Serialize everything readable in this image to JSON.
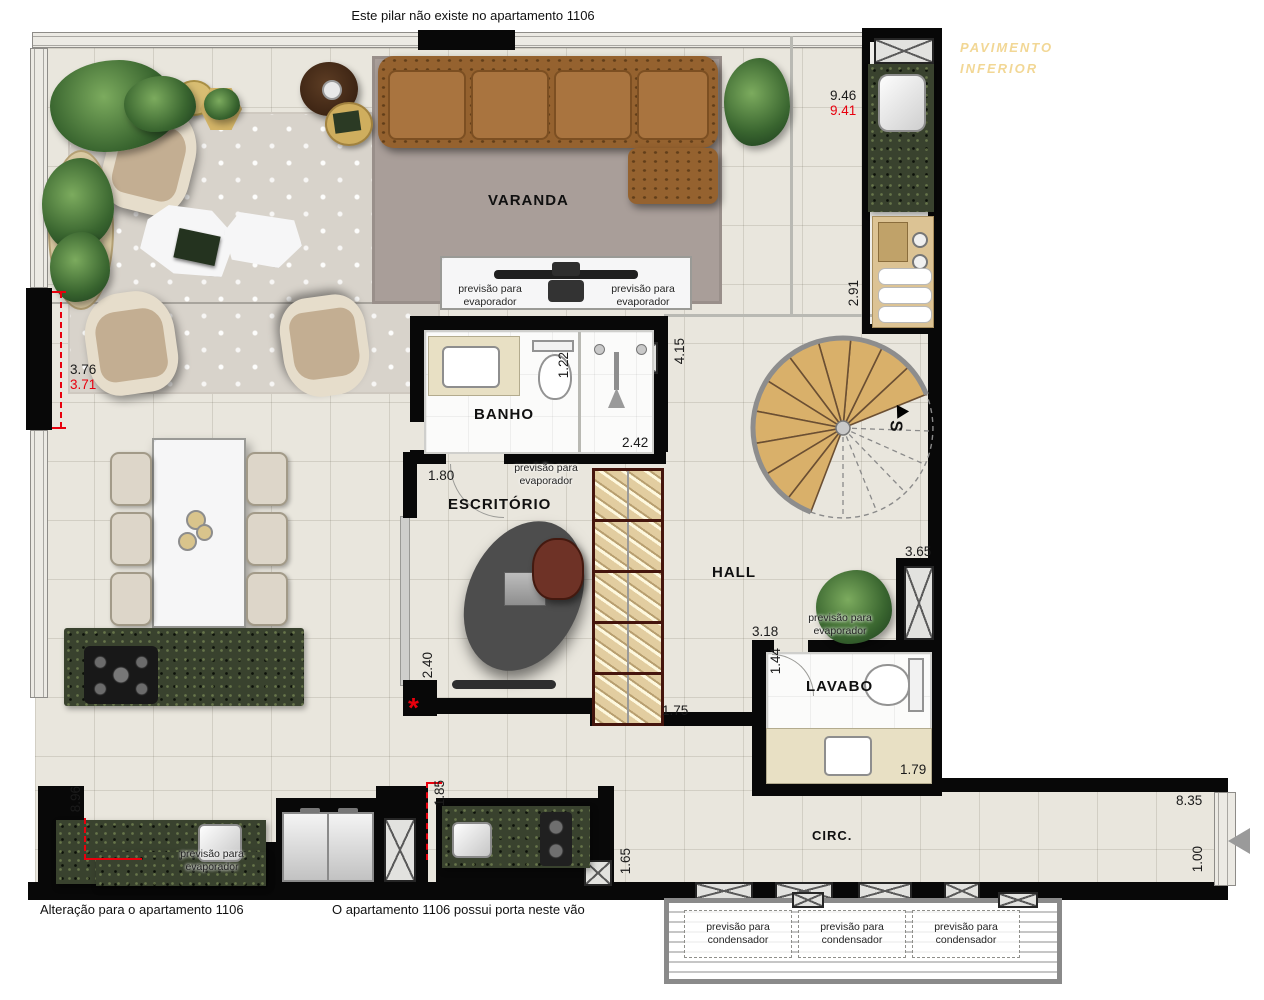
{
  "annotations": {
    "pillar_note": "Este pilar não existe no apartamento 1106",
    "alteration_note": "Alteração para o apartamento 1106",
    "door_note": "O apartamento 1106 possui porta neste vão",
    "lower_floor_line1": "PAVIMENTO",
    "lower_floor_line2": "INFERIOR",
    "asterisk": "*",
    "stair_direction": "S"
  },
  "rooms": {
    "varanda": "VARANDA",
    "banho": "BANHO",
    "escritorio": "ESCRITÓRIO",
    "hall": "HALL",
    "lavabo": "LAVABO",
    "circ": "CIRC."
  },
  "labels": {
    "evaporator": "previsão para evaporador",
    "condenser": "previsão para condensador"
  },
  "dimensions": {
    "d946": "9.46",
    "d941": "9.41",
    "d291": "2.91",
    "d376": "3.76",
    "d371": "3.71",
    "d415": "4.15",
    "d122": "1.22",
    "d242": "2.42",
    "d180": "1.80",
    "d240": "2.40",
    "d175": "1.75",
    "d318": "3.18",
    "d144": "1.44",
    "d365": "3.65",
    "d179": "1.79",
    "d896": "8.96",
    "d185": "1.85",
    "d165": "1.65",
    "d835": "8.35",
    "d100": "1.00"
  },
  "colors": {
    "dimension_alt": "#e8000d",
    "lower_floor_text": "#f2d795",
    "wall": "#080808",
    "granite": "#39422e",
    "stair_wood": "#d9b06a",
    "sofa": "#95622f"
  }
}
